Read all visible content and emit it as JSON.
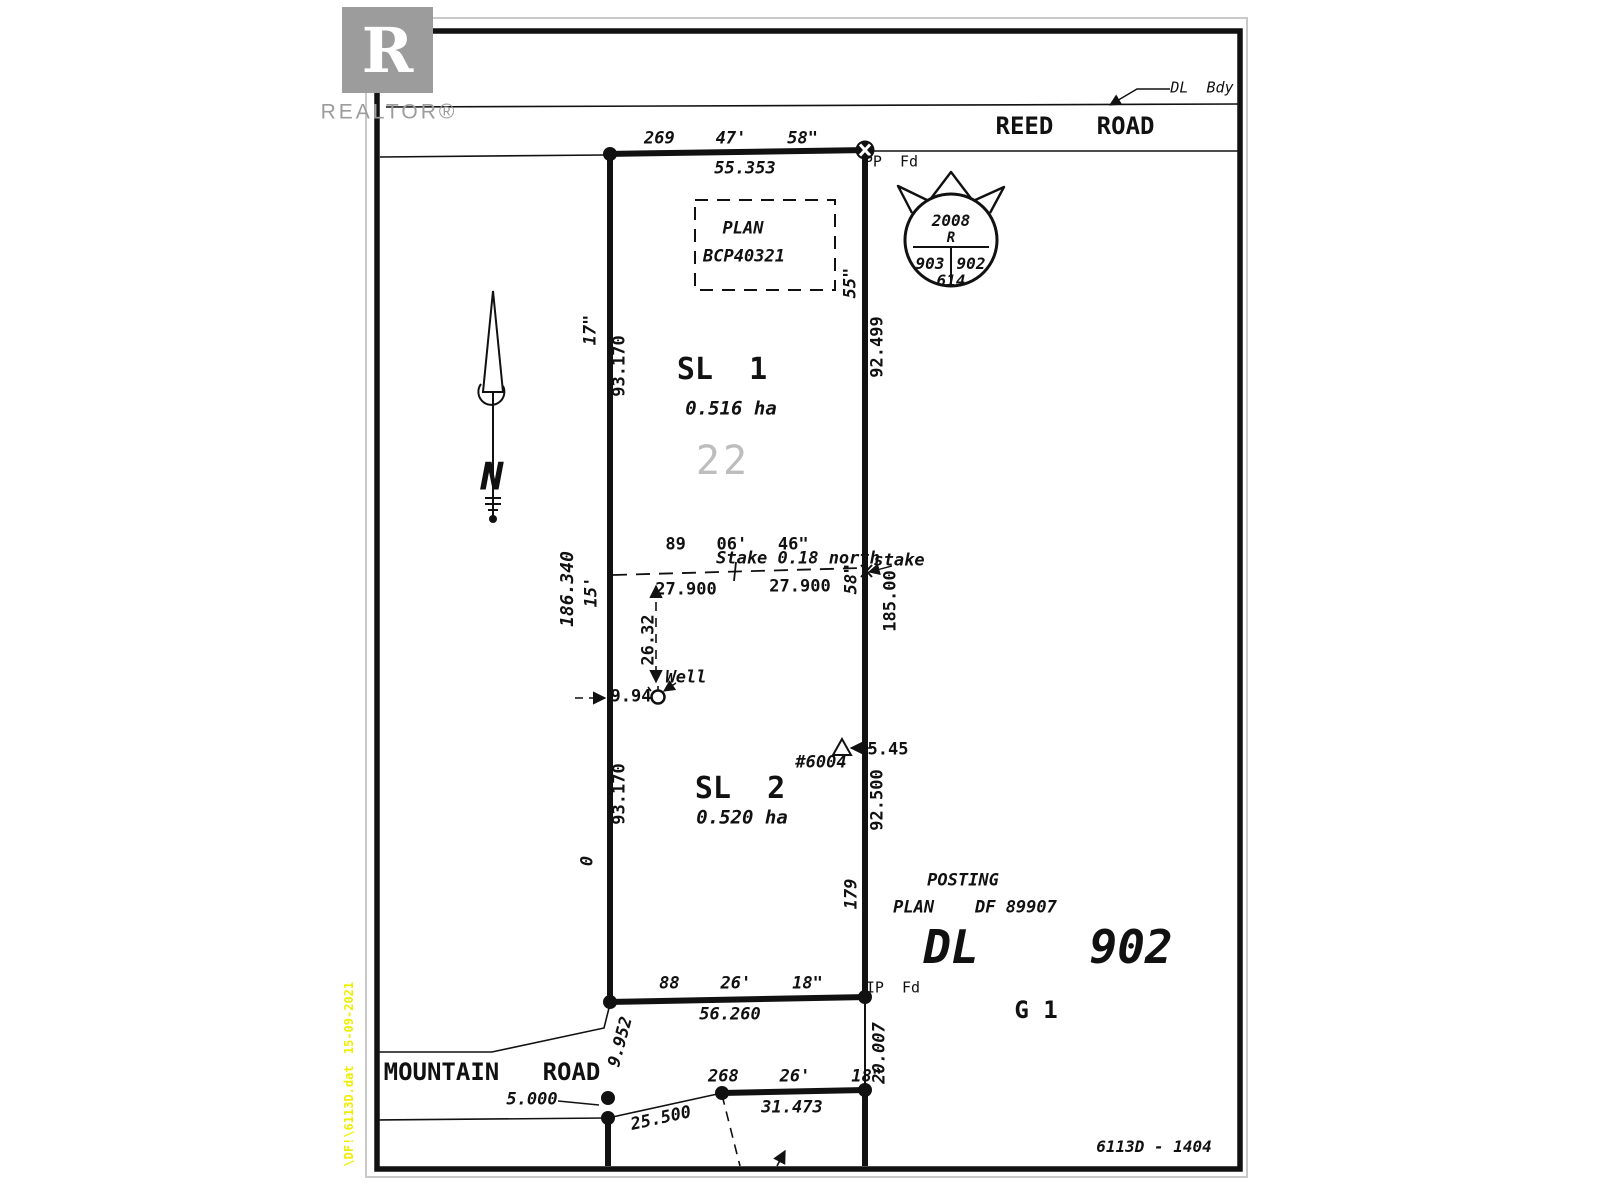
{
  "canvas": {
    "width": 1600,
    "height": 1200,
    "bg": "#ffffff"
  },
  "colors": {
    "ink": "#111111",
    "border_grey": "#c9c9c9",
    "logo_grey": "#9c9c9c",
    "watermark_grey": "#bdbdbd",
    "margin_yellow": "#f0ee00"
  },
  "logo": {
    "letter": "R",
    "brand": "REALTOR®"
  },
  "roads": {
    "reed": "REED   ROAD",
    "mountain": "MOUNTAIN   ROAD"
  },
  "labels": {
    "dl_bdy": "DL  Bdy",
    "pp_fd": "PP  Fd",
    "ip_fd": "IP  Fd",
    "sheet": "6113D - 1404"
  },
  "stamp": {
    "year": "2008",
    "letter": "R",
    "left": "903",
    "right": "902",
    "bottom": "614"
  },
  "plan_box": {
    "line1": "PLAN",
    "line2": "BCP40321"
  },
  "lots": {
    "sl1": {
      "name": "SL  1",
      "area": "0.516 ha",
      "watermark": "22"
    },
    "sl2": {
      "name": "SL  2",
      "area": "0.520 ha"
    }
  },
  "north_arrow": {
    "letter": "N"
  },
  "posting": {
    "line1": "POSTING",
    "line2": "PLAN    DF 89907",
    "district_lot": "DL    902",
    "group": "G 1"
  },
  "notes": {
    "stake_note": "Stake 0.18 north",
    "stake_word": "stake",
    "well": "Well",
    "house": "#6004"
  },
  "dims": {
    "top_bearing": "269    47'    58\"",
    "top_length": "55.353",
    "right_sec1": "55\"",
    "right_len1": "92.499",
    "right_sec2": "58\"",
    "right_total": "185.00",
    "right_len2": "92.500",
    "right_sec3": "179",
    "right_ext": "20.007",
    "left_sec1": "17\"",
    "left_len1": "93.170",
    "left_total": "186.340",
    "left_min": "15'",
    "left_len2": "93.170",
    "left_zero": "0",
    "mid_bearing": "89   06'   46\"",
    "mid_left": "27.900",
    "mid_right": "27.900",
    "well_v": "26.32",
    "well_h": "9.94",
    "house_offset": "5.45",
    "bottom_bearing": "88    26'    18\"",
    "bottom_length": "56.260",
    "sw_tie": "9.952",
    "road_dim": "5.000",
    "road_diag": "25.500",
    "south_bearing": "268    26'    18\"",
    "south_length": "31.473"
  },
  "margin": {
    "date": "15-09-2021",
    "file": "\\DF!\\6113D.dat"
  }
}
